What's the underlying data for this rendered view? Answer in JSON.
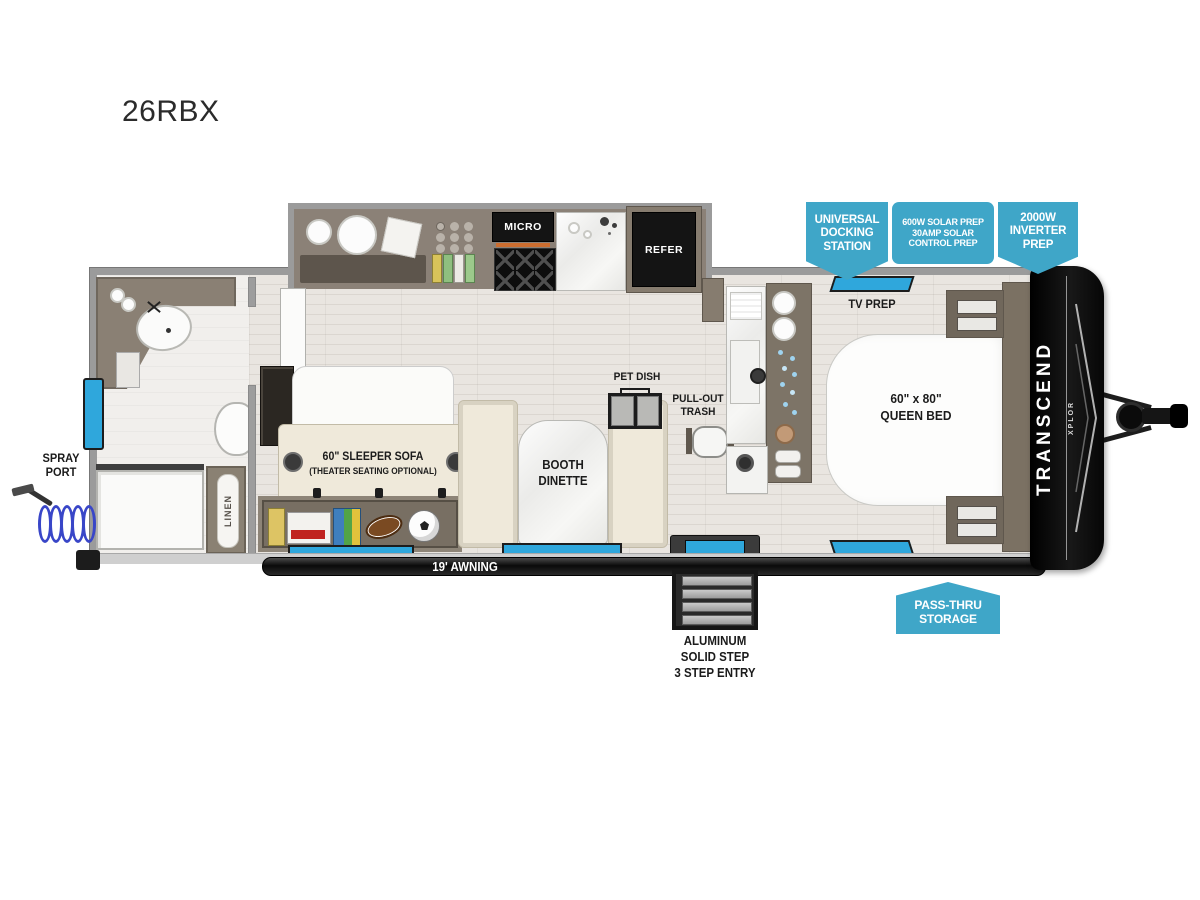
{
  "title": "26RBX",
  "colors": {
    "callout_blue": "#3FA6C8",
    "window_blue": "#2FA7DC",
    "cap_black": "#141414"
  },
  "callouts": {
    "docking": {
      "line1": "UNIVERSAL",
      "line2": "DOCKING",
      "line3": "STATION"
    },
    "solar": {
      "line1": "600W SOLAR PREP",
      "line2": "30AMP SOLAR",
      "line3": "CONTROL PREP"
    },
    "inverter": {
      "line1": "2000W",
      "line2": "INVERTER",
      "line3": "PREP"
    },
    "passthru": {
      "line1": "PASS-THRU",
      "line2": "STORAGE"
    }
  },
  "labels": {
    "micro": "MICRO",
    "refer": "REFER",
    "tv_prep": "TV PREP",
    "bed_line1": "60\" x 80\"",
    "bed_line2": "QUEEN BED",
    "sofa_line1": "60\" SLEEPER SOFA",
    "sofa_line2": "(THEATER SEATING OPTIONAL)",
    "dinette_line1": "BOOTH",
    "dinette_line2": "DINETTE",
    "pet_dish": "PET DISH",
    "trash_line1": "PULL-OUT",
    "trash_line2": "TRASH",
    "linen": "LINEN",
    "spray_line1": "SPRAY",
    "spray_line2": "PORT",
    "awning": "19' AWNING",
    "step_line1": "ALUMINUM",
    "step_line2": "SOLID STEP",
    "step_line3": "3 STEP ENTRY",
    "brand": "TRANSCEND",
    "brand_sub": "XPLOR"
  }
}
